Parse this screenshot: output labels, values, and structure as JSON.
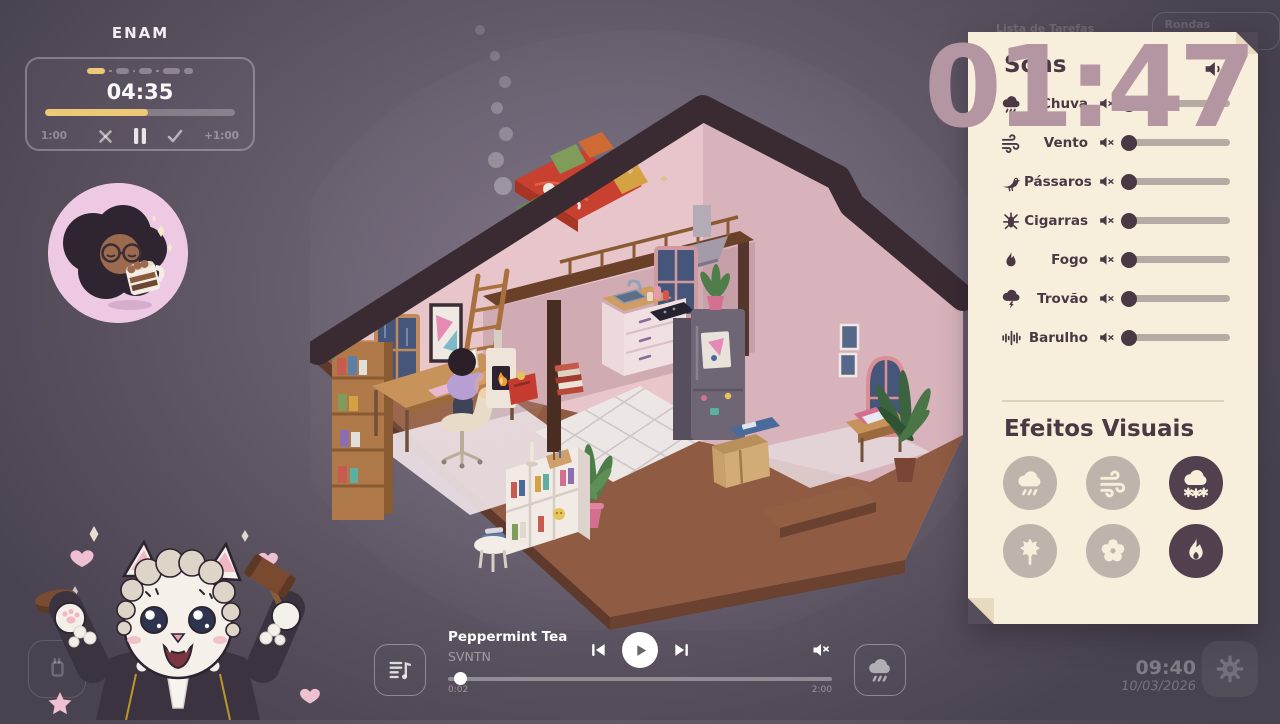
{
  "focus": {
    "title": "ENAM",
    "time": "04:35",
    "progress_pct": 54,
    "segments": [
      {
        "w": 18,
        "on": true
      },
      {
        "w": 13,
        "on": false
      },
      {
        "w": 13,
        "on": false
      },
      {
        "w": 17,
        "on": false
      },
      {
        "w": 9,
        "on": false
      }
    ],
    "subtract_label": "1:00",
    "add_label": "+1:00",
    "cancel_icon": "x-icon",
    "pause_icon": "pause-icon",
    "finish_icon": "check-icon"
  },
  "big_clock": "01:47",
  "tasks": {
    "list_label": "Lista de Tarefas (0/4)",
    "button_label": "Rondas Perdidas"
  },
  "sounds": {
    "title": "Sons",
    "master_icon": "speaker-icon",
    "rows": [
      {
        "icon": "rain-cloud-icon",
        "label": "Chuva",
        "muted": true,
        "value": 0
      },
      {
        "icon": "wind-icon",
        "label": "Vento",
        "muted": true,
        "value": 0
      },
      {
        "icon": "bird-icon",
        "label": "Pássaros",
        "muted": true,
        "value": 0
      },
      {
        "icon": "cicada-icon",
        "label": "Cigarras",
        "muted": true,
        "value": 0
      },
      {
        "icon": "flame-icon",
        "label": "Fogo",
        "muted": true,
        "value": 0
      },
      {
        "icon": "storm-cloud-icon",
        "label": "Trovão",
        "muted": true,
        "value": 0
      },
      {
        "icon": "sound-wave-icon",
        "label": "Barulho",
        "muted": true,
        "value": 0
      }
    ]
  },
  "effects": {
    "title": "Efeitos Visuais",
    "buttons": [
      {
        "icon": "rain-effect-icon",
        "active": false
      },
      {
        "icon": "wind-effect-icon",
        "active": false
      },
      {
        "icon": "snow-effect-icon",
        "active": true
      },
      {
        "icon": "leaves-effect-icon",
        "active": false
      },
      {
        "icon": "flowers-effect-icon",
        "active": false
      },
      {
        "icon": "fire-effect-icon",
        "active": true
      }
    ]
  },
  "player": {
    "track": "Peppermint Tea",
    "artist": "SVNTN",
    "elapsed": "0:02",
    "duration": "2:00",
    "progress_pct": 1.5,
    "muted": true
  },
  "system": {
    "time": "09:40",
    "date": "10/03/2026"
  },
  "colors": {
    "accent_gold": "#ecc878",
    "paper": "#f7efdb",
    "ink": "#4a3844",
    "big_clock": "#b495a2",
    "effect_active": "#53404e",
    "effect_inactive": "#bfb4ac"
  }
}
